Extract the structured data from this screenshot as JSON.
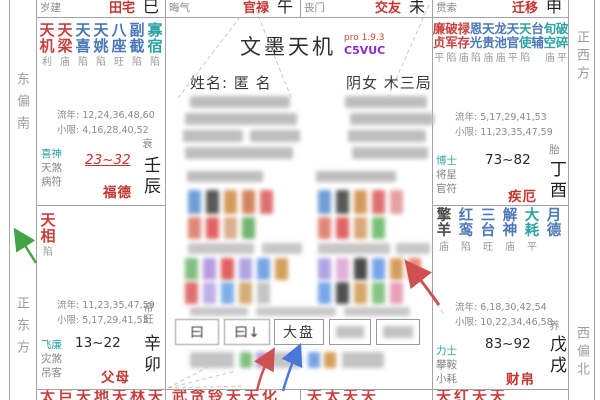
{
  "app": {
    "title": "文墨天机",
    "version": "pro 1.9.3",
    "code": "C5VUC"
  },
  "person": {
    "name_line": "姓名: 匿 名",
    "gender_line": "阴女 木三局"
  },
  "compass": {
    "east_south": "东偏南",
    "east": "正东方",
    "west": "正西方",
    "west_north": "西偏北"
  },
  "top_strip": [
    {
      "god": "岁建",
      "name": "田宅",
      "branch": "巳"
    },
    {
      "god": "晦气",
      "name": "官禄",
      "branch": "午"
    },
    {
      "god": "丧门",
      "name": "交友",
      "branch": "未"
    },
    {
      "god": "贯索",
      "name": "迁移",
      "branch": "申"
    }
  ],
  "palaces": {
    "chen": {
      "stars": [
        [
          "天机",
          "利",
          "red"
        ],
        [
          "天梁",
          "庙",
          "red"
        ],
        [
          "天喜",
          "陷",
          "blue"
        ],
        [
          "天姚",
          "陷",
          "blue"
        ],
        [
          "八座",
          "旺",
          "blue"
        ],
        [
          "副截",
          "陷",
          "blue"
        ],
        [
          "寡宿",
          "陷",
          "teal"
        ]
      ],
      "liunian": "流年: 12,24,36,48,60",
      "xiaoxian": "小限: 4,16,28,40,52",
      "gods": [
        [
          "喜神",
          "teal"
        ],
        [
          "天煞",
          "gray"
        ],
        [
          "病符",
          "gray"
        ]
      ],
      "decade": "23~32",
      "name": "福德",
      "stage": "衰",
      "ganzhi": "壬辰"
    },
    "mao": {
      "stars": [
        [
          "天相",
          "陷",
          "red"
        ]
      ],
      "liunian": "流年: 11,23,35,47,59",
      "xiaoxian": "小限: 5,17,29,41,53",
      "gods": [
        [
          "飞廉",
          "teal"
        ],
        [
          "灾煞",
          "gray"
        ],
        [
          "吊客",
          "gray"
        ]
      ],
      "decade": "13~22",
      "name": "父母",
      "stage": "帝旺",
      "ganzhi": "辛卯"
    },
    "you": {
      "stars": [
        [
          "廉贞",
          "平",
          "red"
        ],
        [
          "破军",
          "陷",
          "red"
        ],
        [
          "禄存",
          "庙",
          "red"
        ],
        [
          "恩光",
          "陷",
          "blue"
        ],
        [
          "天贵",
          "庙",
          "blue"
        ],
        [
          "龙池",
          "庙",
          "blue"
        ],
        [
          "天官",
          "平",
          "blue"
        ],
        [
          "天使",
          "陷",
          "teal"
        ],
        [
          "台辅",
          "",
          "blue"
        ],
        [
          "旬空",
          "庙",
          "teal"
        ],
        [
          "破碎",
          "平",
          "teal"
        ]
      ],
      "liunian": "流年: 5,17,29,41,53",
      "xiaoxian": "小限: 11,23,35,47,59",
      "gods": [
        [
          "博士",
          "teal"
        ],
        [
          "将星",
          "gray"
        ],
        [
          "官符",
          "gray"
        ]
      ],
      "decade": "73~82",
      "name": "疾厄",
      "stage": "胎",
      "ganzhi": "丁酉"
    },
    "xu": {
      "stars": [
        [
          "擎羊",
          "庙",
          "dark"
        ],
        [
          "红鸾",
          "陷",
          "blue"
        ],
        [
          "三台",
          "旺",
          "blue"
        ],
        [
          "解神",
          "庙",
          "blue"
        ],
        [
          "大耗",
          "平",
          "teal"
        ],
        [
          "月德",
          "",
          "blue"
        ]
      ],
      "liunian": "流年: 6,18,30,42,54",
      "xiaoxian": "小限: 10,22,34,46,58",
      "gods": [
        [
          "力士",
          "teal"
        ],
        [
          "攀鞍",
          "gray"
        ],
        [
          "小耗",
          "gray"
        ]
      ],
      "decade": "83~92",
      "name": "财帛",
      "stage": "养",
      "ganzhi": "戊戌"
    }
  },
  "bottom_strip": [
    "太巨天地天林天",
    "武贪铃天天化",
    "天太天天",
    "天红天天"
  ],
  "buttons": [
    {
      "label": "曰"
    },
    {
      "label": "曰↓"
    },
    {
      "label": "大盘"
    },
    {
      "label": ""
    },
    {
      "label": ""
    }
  ],
  "colors": {
    "star_red": "#c9413e",
    "star_blue": "#4a78b8",
    "star_teal": "#2fa3a3",
    "star_dark": "#4a4a4a",
    "palace_name_red": "#c5342f",
    "version_red": "#cc4433",
    "code_purple": "#8a2bd0",
    "arrow_green": "#44a344",
    "arrow_red": "#cf5050",
    "arrow_blue": "#4a78d8",
    "grid": "#a3a3a3"
  },
  "mosaic": {
    "cells": [
      [
        190,
        96,
        100,
        12,
        "#bdbdbd"
      ],
      [
        345,
        96,
        82,
        12,
        "#bdbdbd"
      ],
      [
        185,
        113,
        112,
        12,
        "#bdbdbd"
      ],
      [
        350,
        113,
        84,
        12,
        "#bdbdbd"
      ],
      [
        183,
        130,
        60,
        12,
        "#bdbdbd"
      ],
      [
        250,
        130,
        50,
        12,
        "#bdbdbd"
      ],
      [
        348,
        130,
        78,
        12,
        "#bdbdbd"
      ],
      [
        185,
        147,
        108,
        12,
        "#bdbdbd"
      ],
      [
        352,
        147,
        76,
        12,
        "#bdbdbd"
      ],
      [
        187,
        171,
        76,
        11,
        "#bdbdbd"
      ],
      [
        316,
        171,
        80,
        11,
        "#bdbdbd"
      ],
      [
        188,
        190,
        13,
        24,
        "#6f9fd8"
      ],
      [
        206,
        190,
        13,
        24,
        "#585858"
      ],
      [
        224,
        190,
        13,
        24,
        "#d49a5c"
      ],
      [
        242,
        190,
        13,
        24,
        "#d4845c"
      ],
      [
        260,
        190,
        13,
        24,
        "#e07070"
      ],
      [
        318,
        190,
        13,
        24,
        "#6f9fd8"
      ],
      [
        336,
        190,
        13,
        24,
        "#585858"
      ],
      [
        354,
        190,
        13,
        24,
        "#d49a5c"
      ],
      [
        372,
        190,
        13,
        24,
        "#e07070"
      ],
      [
        390,
        190,
        13,
        24,
        "#e8a0a0"
      ],
      [
        188,
        217,
        13,
        22,
        "#e08878"
      ],
      [
        206,
        217,
        13,
        22,
        "#e06464"
      ],
      [
        224,
        217,
        13,
        22,
        "#d8b08c"
      ],
      [
        242,
        217,
        13,
        22,
        "#74b474"
      ],
      [
        318,
        217,
        13,
        22,
        "#e08878"
      ],
      [
        336,
        217,
        13,
        22,
        "#e06464"
      ],
      [
        354,
        217,
        13,
        22,
        "#d8a878"
      ],
      [
        372,
        217,
        13,
        22,
        "#78c078"
      ],
      [
        188,
        243,
        66,
        11,
        "#c6c6c6"
      ],
      [
        262,
        243,
        40,
        11,
        "#c6c6c6"
      ],
      [
        318,
        243,
        72,
        11,
        "#c6c6c6"
      ],
      [
        396,
        243,
        34,
        11,
        "#c6c6c6"
      ],
      [
        185,
        258,
        13,
        22,
        "#80c080"
      ],
      [
        203,
        258,
        13,
        22,
        "#b89ce0"
      ],
      [
        221,
        258,
        13,
        22,
        "#e06060"
      ],
      [
        239,
        258,
        13,
        22,
        "#b0a4e4"
      ],
      [
        257,
        258,
        13,
        22,
        "#78a4e4"
      ],
      [
        275,
        258,
        13,
        22,
        "#d4a05c"
      ],
      [
        318,
        258,
        13,
        22,
        "#b0a4e4"
      ],
      [
        336,
        258,
        13,
        22,
        "#e0b0d8"
      ],
      [
        354,
        258,
        13,
        22,
        "#4a4a4a"
      ],
      [
        372,
        258,
        13,
        22,
        "#78a4e8"
      ],
      [
        390,
        258,
        13,
        22,
        "#d4a05c"
      ],
      [
        408,
        258,
        13,
        22,
        "#e88c74"
      ],
      [
        185,
        282,
        13,
        22,
        "#e07070"
      ],
      [
        203,
        282,
        13,
        22,
        "#c0b0e8"
      ],
      [
        221,
        282,
        13,
        22,
        "#80b0e8"
      ],
      [
        239,
        282,
        13,
        22,
        "#d4ac74"
      ],
      [
        257,
        282,
        13,
        22,
        "#c4c4c4"
      ],
      [
        318,
        282,
        13,
        22,
        "#78a8e8"
      ],
      [
        336,
        282,
        13,
        22,
        "#505050"
      ],
      [
        354,
        282,
        13,
        22,
        "#d4a868"
      ],
      [
        372,
        282,
        13,
        22,
        "#84c484"
      ],
      [
        390,
        282,
        13,
        22,
        "#e8a0b8"
      ],
      [
        190,
        307,
        58,
        9,
        "#c8c8c8"
      ],
      [
        256,
        307,
        80,
        9,
        "#c8c8c8"
      ],
      [
        344,
        307,
        66,
        9,
        "#c8c8c8"
      ],
      [
        190,
        352,
        44,
        16,
        "#c4c4c4"
      ],
      [
        240,
        352,
        12,
        16,
        "#80c080"
      ],
      [
        256,
        352,
        12,
        16,
        "#b89ce0"
      ],
      [
        272,
        352,
        30,
        16,
        "#c4c4c4"
      ],
      [
        308,
        352,
        12,
        16,
        "#78a4e4"
      ],
      [
        324,
        352,
        12,
        16,
        "#d4a05c"
      ],
      [
        342,
        352,
        42,
        16,
        "#c4c4c4"
      ]
    ]
  }
}
